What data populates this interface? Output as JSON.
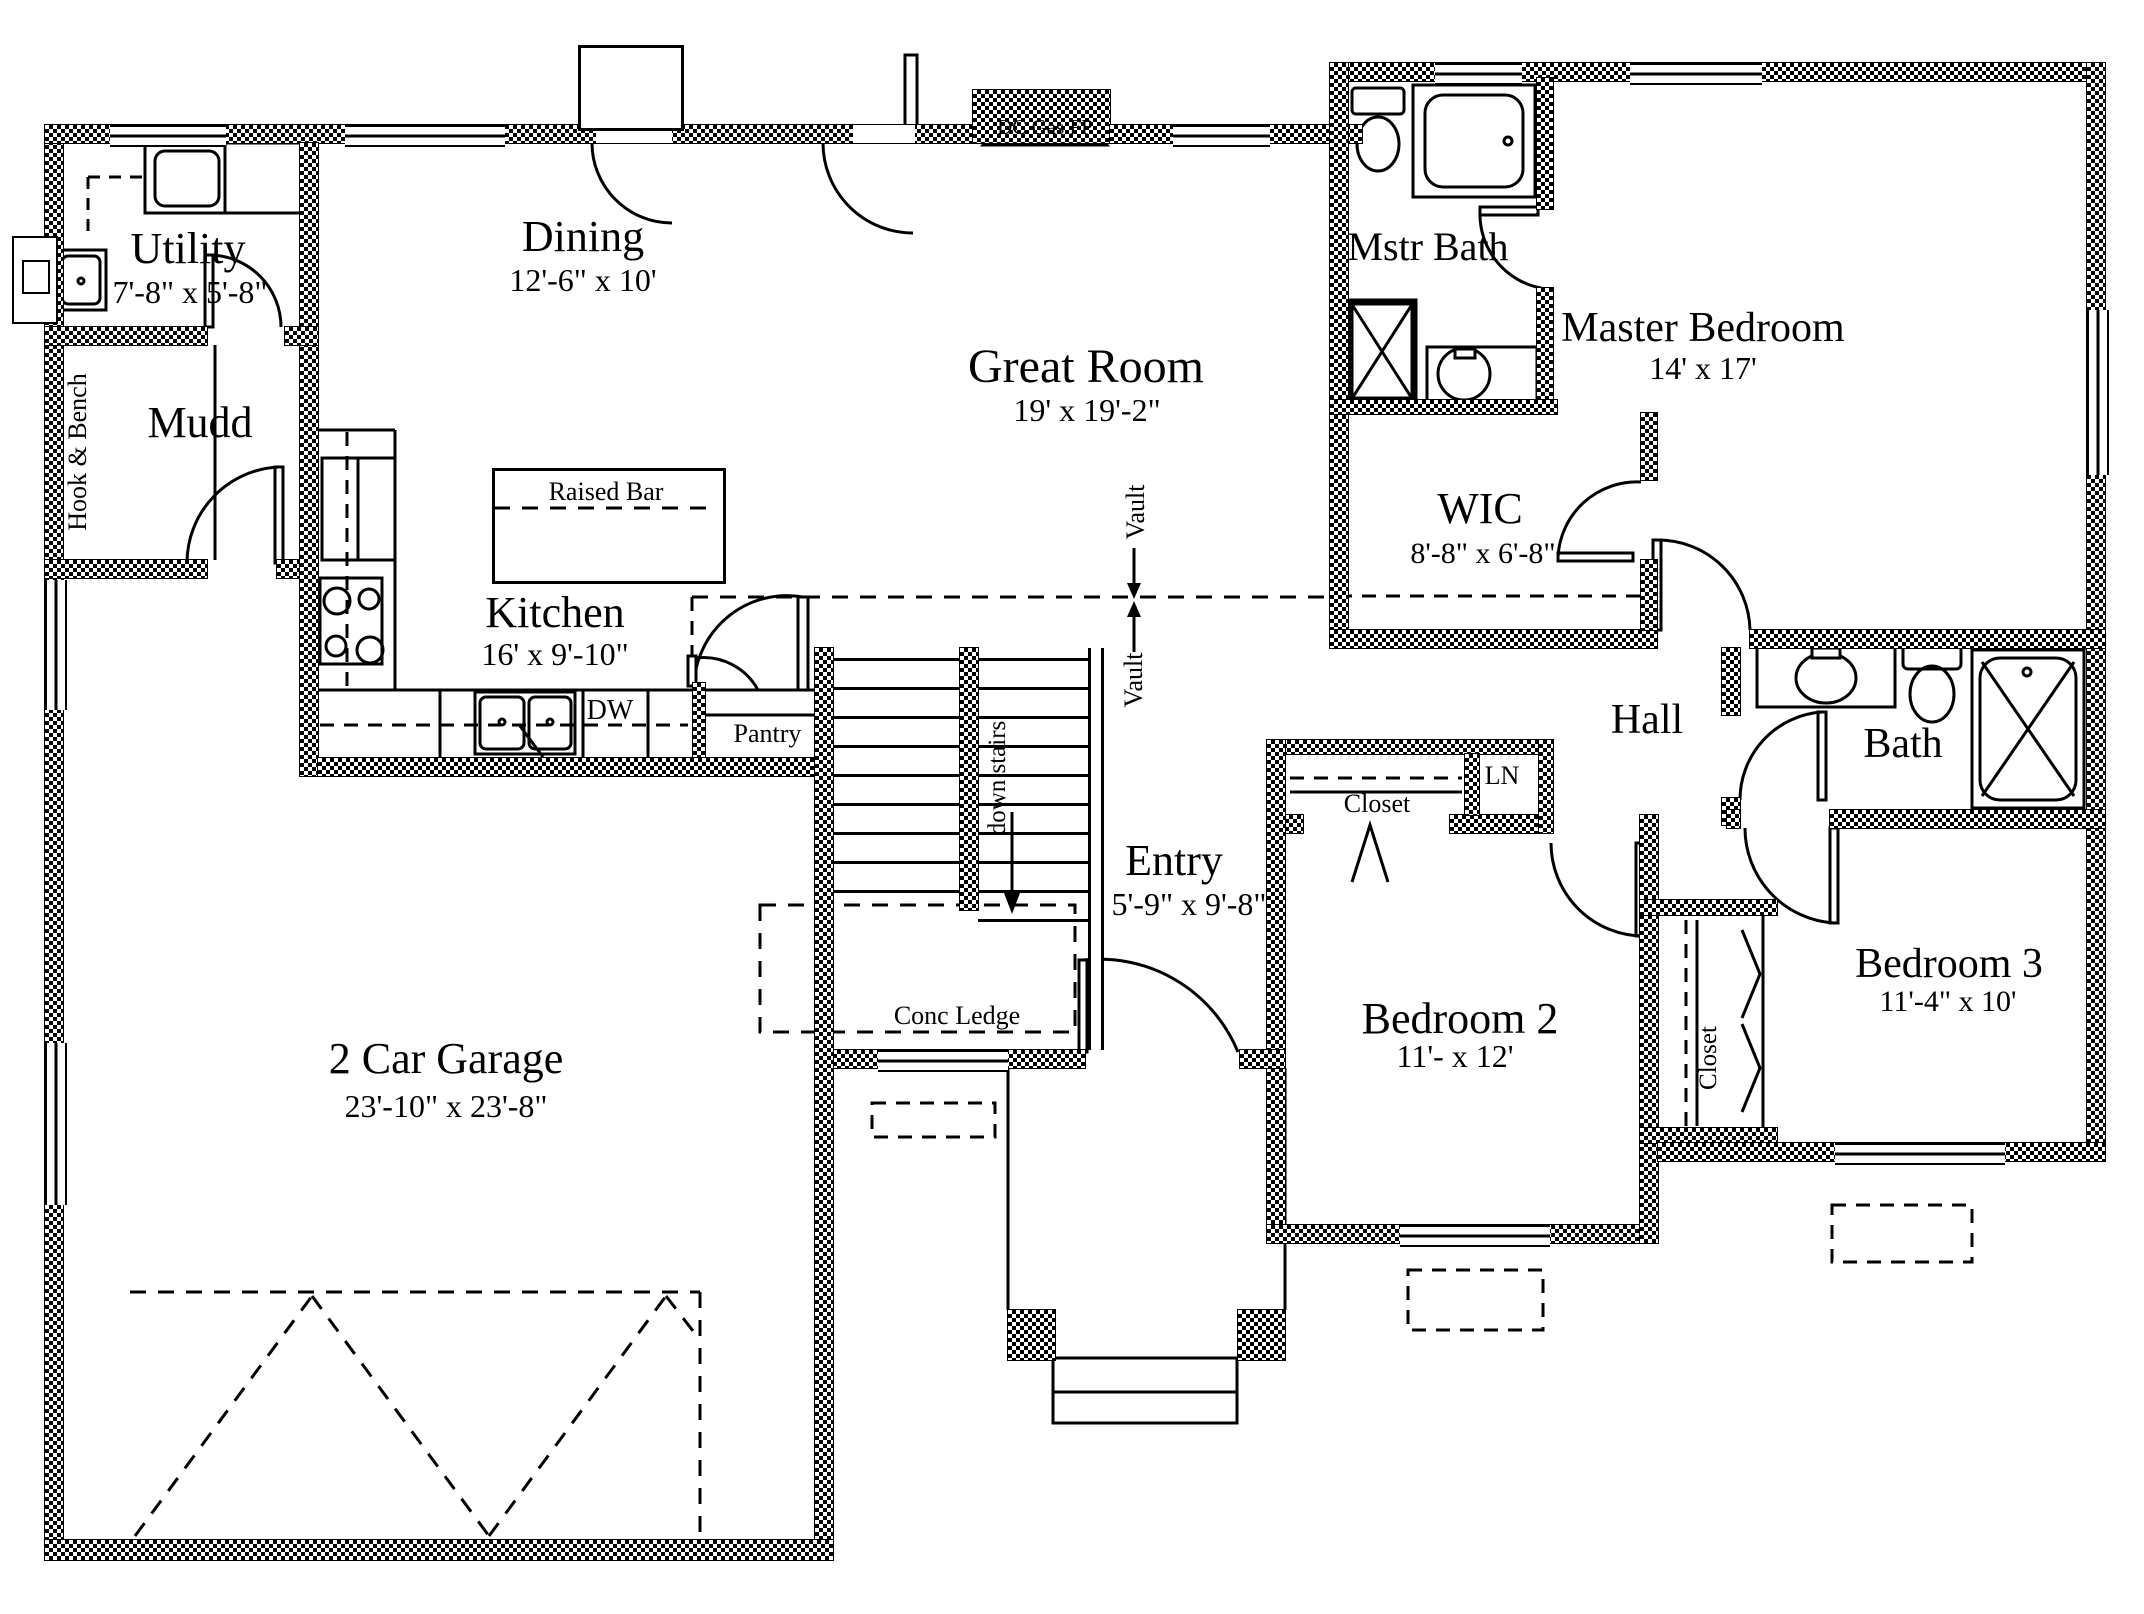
{
  "rooms": {
    "utility": {
      "name": "Utility",
      "dims": "7'-8\" x 5'-8\""
    },
    "mudd": {
      "name": "Mudd"
    },
    "dining": {
      "name": "Dining",
      "dims": "12'-6\" x 10'"
    },
    "great_room": {
      "name": "Great Room",
      "dims": "19' x 19'-2\""
    },
    "kitchen": {
      "name": "Kitchen",
      "dims": "16' x 9'-10\""
    },
    "mstr_bath": {
      "name": "Mstr Bath"
    },
    "master_bedroom": {
      "name": "Master Bedroom",
      "dims": "14' x 17'"
    },
    "wic": {
      "name": "WIC",
      "dims": "8'-8\" x 6'-8\""
    },
    "hall": {
      "name": "Hall"
    },
    "bath": {
      "name": "Bath"
    },
    "entry": {
      "name": "Entry",
      "dims": "5'-9\" x 9'-8\""
    },
    "bedroom2": {
      "name": "Bedroom 2",
      "dims": "11'- x 12'"
    },
    "bedroom3": {
      "name": "Bedroom 3",
      "dims": "11'-4\" x 10'"
    },
    "garage": {
      "name": "2 Car Garage",
      "dims": "23'-10\" x 23'-8\""
    }
  },
  "annotations": {
    "fireplace": "DC Gas FP",
    "raised_bar": "Raised Bar",
    "dishwasher": "DW",
    "pantry": "Pantry",
    "hook_bench": "Hook & Bench",
    "down_stairs": "down stairs",
    "conc_ledge": "Conc Ledge",
    "closet_bed2": "Closet",
    "linen": "LN",
    "closet_bed3": "Closet",
    "vault_upper": "Vault",
    "vault_lower": "Vault"
  },
  "colors": {
    "wall": "#000000",
    "background": "#ffffff",
    "line": "#000000"
  }
}
